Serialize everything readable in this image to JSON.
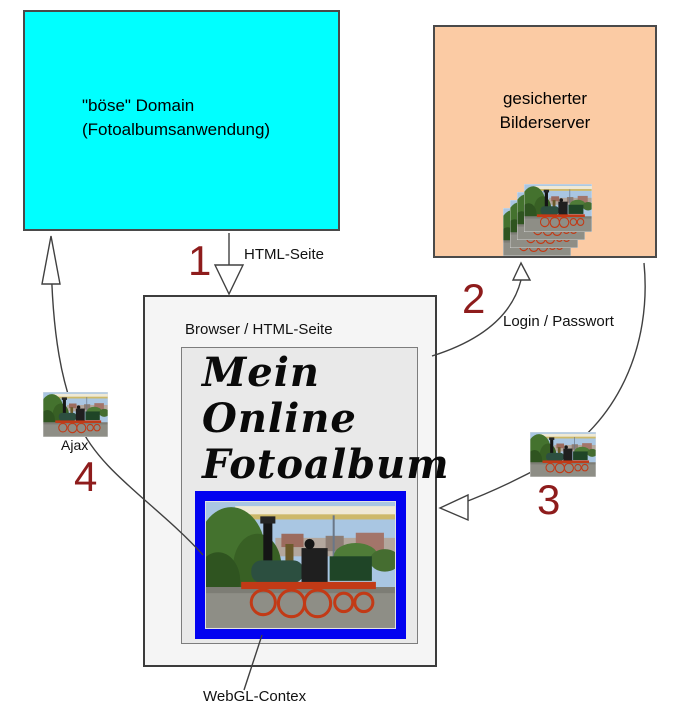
{
  "diagram": {
    "bad_domain_box": {
      "line1": "\"böse\" Domain",
      "line2": "(Fotoalbumsanwendung)"
    },
    "image_server_box": {
      "line1": "gesicherter",
      "line2": "Bilderserver"
    },
    "browser_box": {
      "label": "Browser / HTML-Seite"
    },
    "album": {
      "title_line1": "Mein",
      "title_line2": "Online",
      "title_line3": "Fotoalbum"
    },
    "steps": {
      "step1": {
        "number": "1",
        "label": "HTML-Seite"
      },
      "step2": {
        "number": "2",
        "label": "Login / Passwort"
      },
      "step3": {
        "number": "3"
      },
      "step4": {
        "number": "4",
        "label": "Ajax"
      }
    },
    "webgl_label": "WebGL-Contex",
    "colors": {
      "bad_domain_bg": "#00ffff",
      "server_bg": "#fbcba4",
      "browser_bg": "#f5f5f5",
      "album_page_bg": "#e9e9e9",
      "frame_blue": "#0202f0",
      "step_number": "#8e1c1c",
      "arrow_stroke": "#404040"
    }
  }
}
